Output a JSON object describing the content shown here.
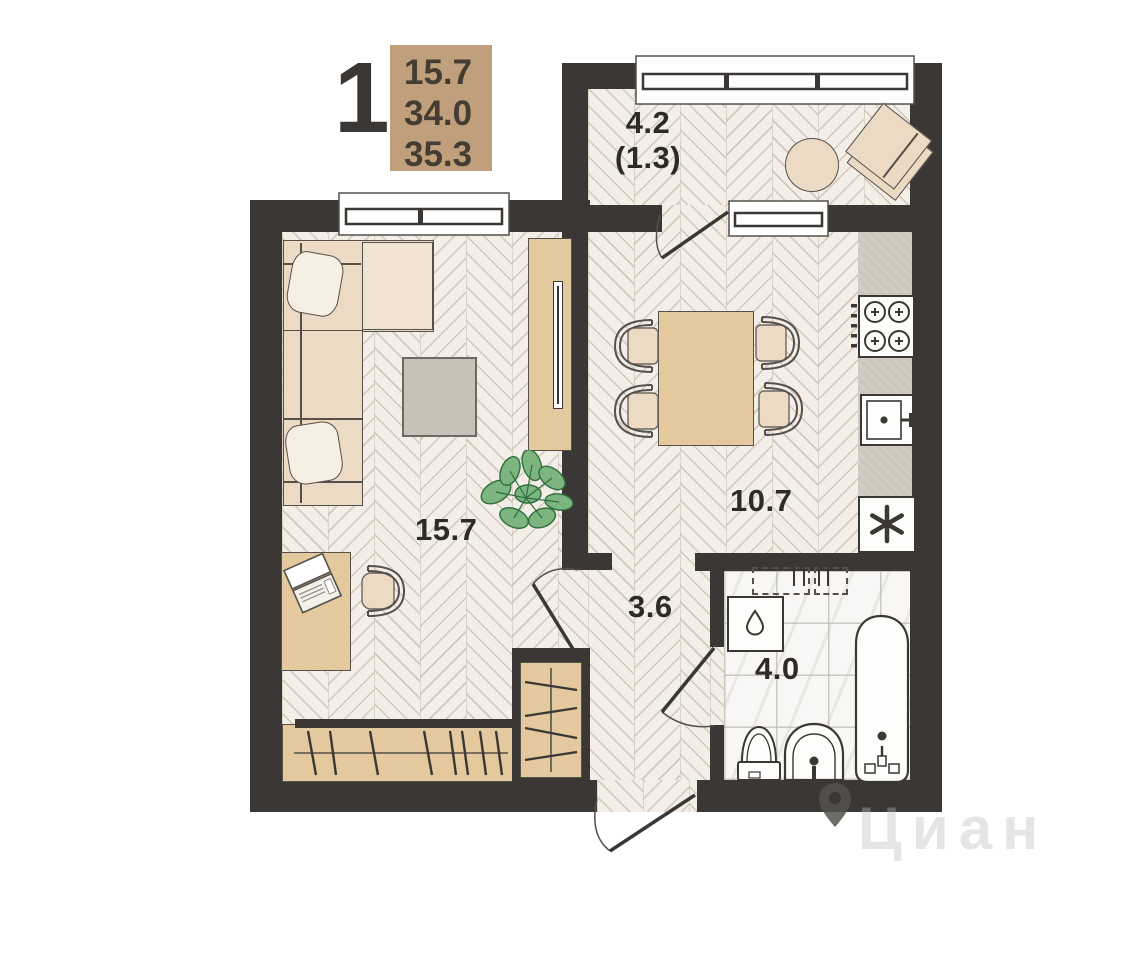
{
  "header": {
    "rooms_count": "1",
    "area_rows": [
      "15.7",
      "34.0",
      "35.3"
    ]
  },
  "rooms": {
    "balcony": {
      "label": "4.2",
      "label_secondary": "(1.3)"
    },
    "living_room": {
      "label": "15.7"
    },
    "kitchen": {
      "label": "10.7"
    },
    "hallway": {
      "label": "3.6"
    },
    "bathroom": {
      "label": "4.0"
    }
  },
  "watermark": {
    "brand": "Циан",
    "icon": "map-pin"
  },
  "icons": {
    "fridge": "asterisk",
    "washing_machine": "water-drop",
    "stove": "four-burners"
  },
  "colors": {
    "wall": "#3a3734",
    "accent_tan": "#c0a07c",
    "wood_furniture": "#e3c99d",
    "upholstery": "#ecdac5",
    "floor": "#f3eee7",
    "plant_green": "#7cb580"
  }
}
